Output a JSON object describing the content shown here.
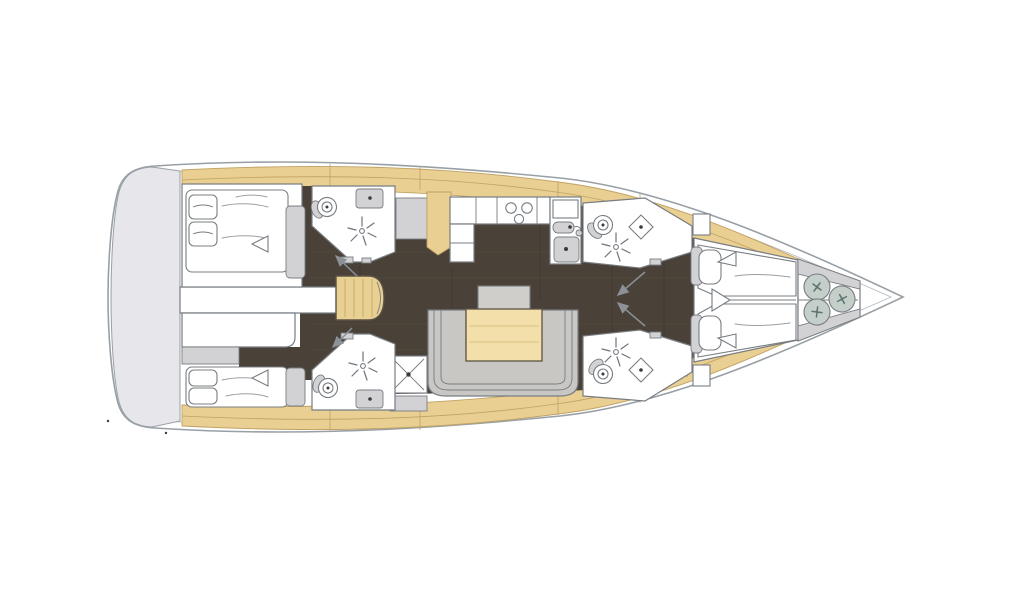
{
  "figure": {
    "label": "Sailing yacht interior deck layout plan, bow pointing right",
    "type": "floor-plan"
  },
  "colors": {
    "hull_stroke": "#98a0a6",
    "hull_fill": "#ffffff",
    "transom": "#e6e6eb",
    "deck": "#eacf92",
    "deck_stroke": "#bfa264",
    "floor": "#4a4138",
    "floor_grain_light": "#5a5044",
    "floor_grain_dark": "#3f372e",
    "line": "#787d82",
    "gray": "#d2d2d5",
    "sofa": "#c9c7c3",
    "stool": "#cfcecb",
    "table_tan": "#f2dfa9",
    "stairs_tan": "#e8cf92",
    "wood_stroke": "#5c5344",
    "fender": "#c4cfc9",
    "arrow": "#8b9196",
    "ink": "#3a3a3a"
  },
  "rooms": [
    {
      "id": "transom-platform",
      "label": "Stern swim platform"
    },
    {
      "id": "aft-cabin-port",
      "label": "Aft double cabin, port side"
    },
    {
      "id": "aft-cabin-starboard",
      "label": "Aft double cabin, starboard side"
    },
    {
      "id": "aft-head-port",
      "label": "Aft head with shower, port side"
    },
    {
      "id": "aft-head-starboard",
      "label": "Aft head with shower, starboard side"
    },
    {
      "id": "companionway",
      "label": "Companionway stairs"
    },
    {
      "id": "galley",
      "label": "Galley with stove and twin sinks"
    },
    {
      "id": "salon",
      "label": "Salon with U-shaped sofa and table"
    },
    {
      "id": "shower-stall",
      "label": "Separate shower stall"
    },
    {
      "id": "fwd-head-port",
      "label": "Forward head, port side"
    },
    {
      "id": "fwd-head-starboard",
      "label": "Forward head, starboard side"
    },
    {
      "id": "forward-cabin",
      "label": "Forward cabin with twin V-berths"
    },
    {
      "id": "bow-locker",
      "label": "Bow locker with fenders"
    }
  ],
  "icons": [
    "toilet-icon",
    "shower-icon",
    "sink-icon",
    "stove-burner-icon",
    "faucet-icon",
    "fender-icon",
    "door-swing-arrow",
    "bed",
    "pillow",
    "sofa",
    "table",
    "stairs"
  ]
}
